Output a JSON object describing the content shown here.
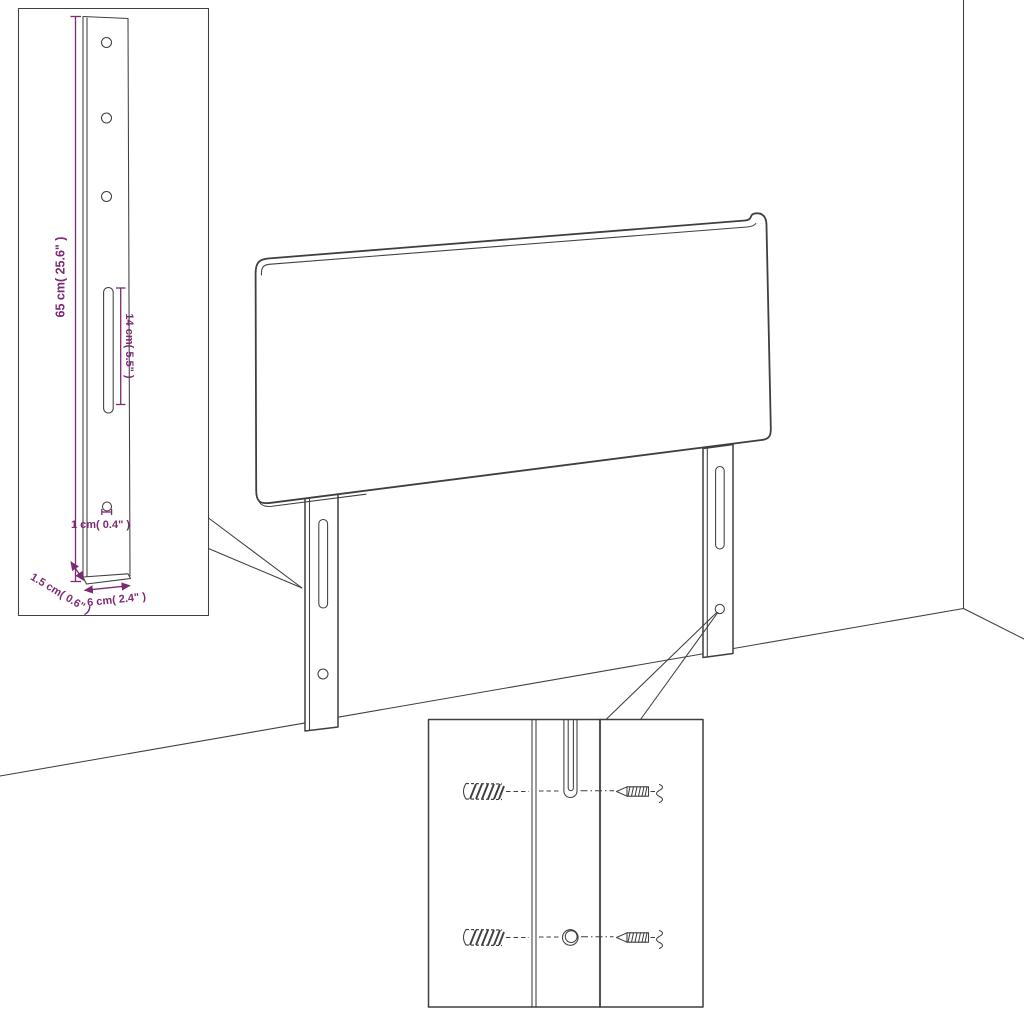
{
  "colors": {
    "accent": "#7c2a72",
    "line": "#3f3f3f"
  },
  "dimension_inset": {
    "height_label": "65 cm( 25.6\" )",
    "slot_label": "14 cm( 5.5\" )",
    "hole_label": "1 cm( 0.4\" )",
    "width_label": "6 cm( 2.4\" )",
    "depth_label": "1.5 cm( 0.6\" )"
  }
}
